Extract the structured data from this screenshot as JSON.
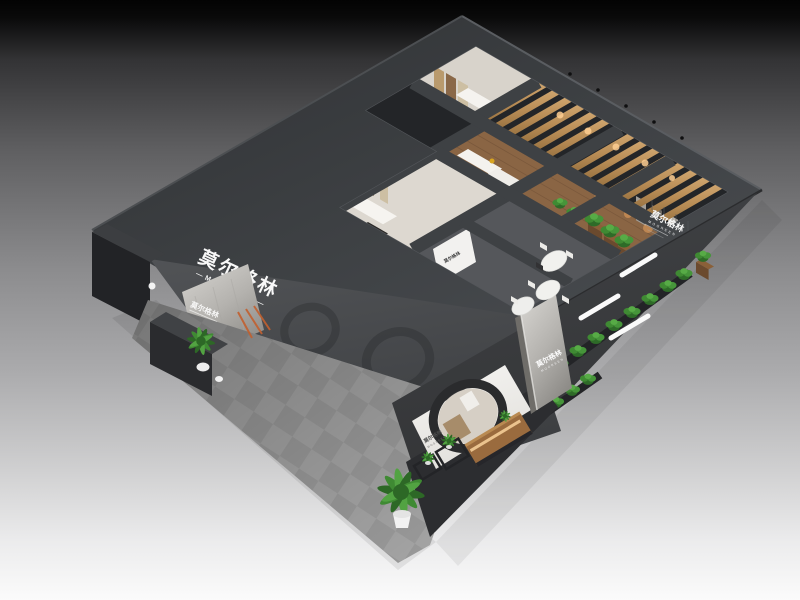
{
  "brand": {
    "zh": "莫尔格林",
    "en": "MOGREEN"
  },
  "signs": {
    "main": {
      "zh": "莫尔格林",
      "en": "—MOGREEN—"
    },
    "marble_panel": {
      "zh": "莫尔格林"
    },
    "pillar": {
      "zh": "莫尔格林",
      "en": "MOGREEN"
    },
    "right_wall": {
      "zh": "莫尔格林",
      "en": "MOGREEN"
    },
    "counter": {
      "zh": "莫尔格林"
    },
    "display_wall": {
      "zh": "莫尔格林",
      "en": "MOGREEN"
    }
  },
  "colors": {
    "background_top": "#030303",
    "background_bottom": "#fbfbfb",
    "booth_charcoal": "#3a3d40",
    "roof_dark": "#323437",
    "fascia_gray": "#47494d",
    "interior_base": "#232528",
    "room_white": "#d8d3cb",
    "wood_floor": "#8a6544",
    "wood_slat": "#c49a62",
    "meeting_floor": "#55575b",
    "carpet_gray": "#a4a4a4",
    "marble_light": "#c9c6c1",
    "plant_green": "#3f8a33",
    "planter_brown": "#6b4a2e",
    "warm_light": "#ffcf92",
    "logo_white": "#f8f8f8",
    "plinth_dark": "#2c2d30",
    "wood_cabinet": "#9a6b3e",
    "accent_orange": "#c2602f"
  },
  "scene": {
    "subject": "Bird's-eye 3D render of a dark exhibition booth",
    "objects": [
      "wood-slat-ceiling",
      "ceiling-beams",
      "showrooms",
      "wood-corridor",
      "meeting-tables",
      "hedge-planters",
      "carpet",
      "reception-desk",
      "potted-plants",
      "circle-display-wall",
      "marble-pillar"
    ]
  }
}
